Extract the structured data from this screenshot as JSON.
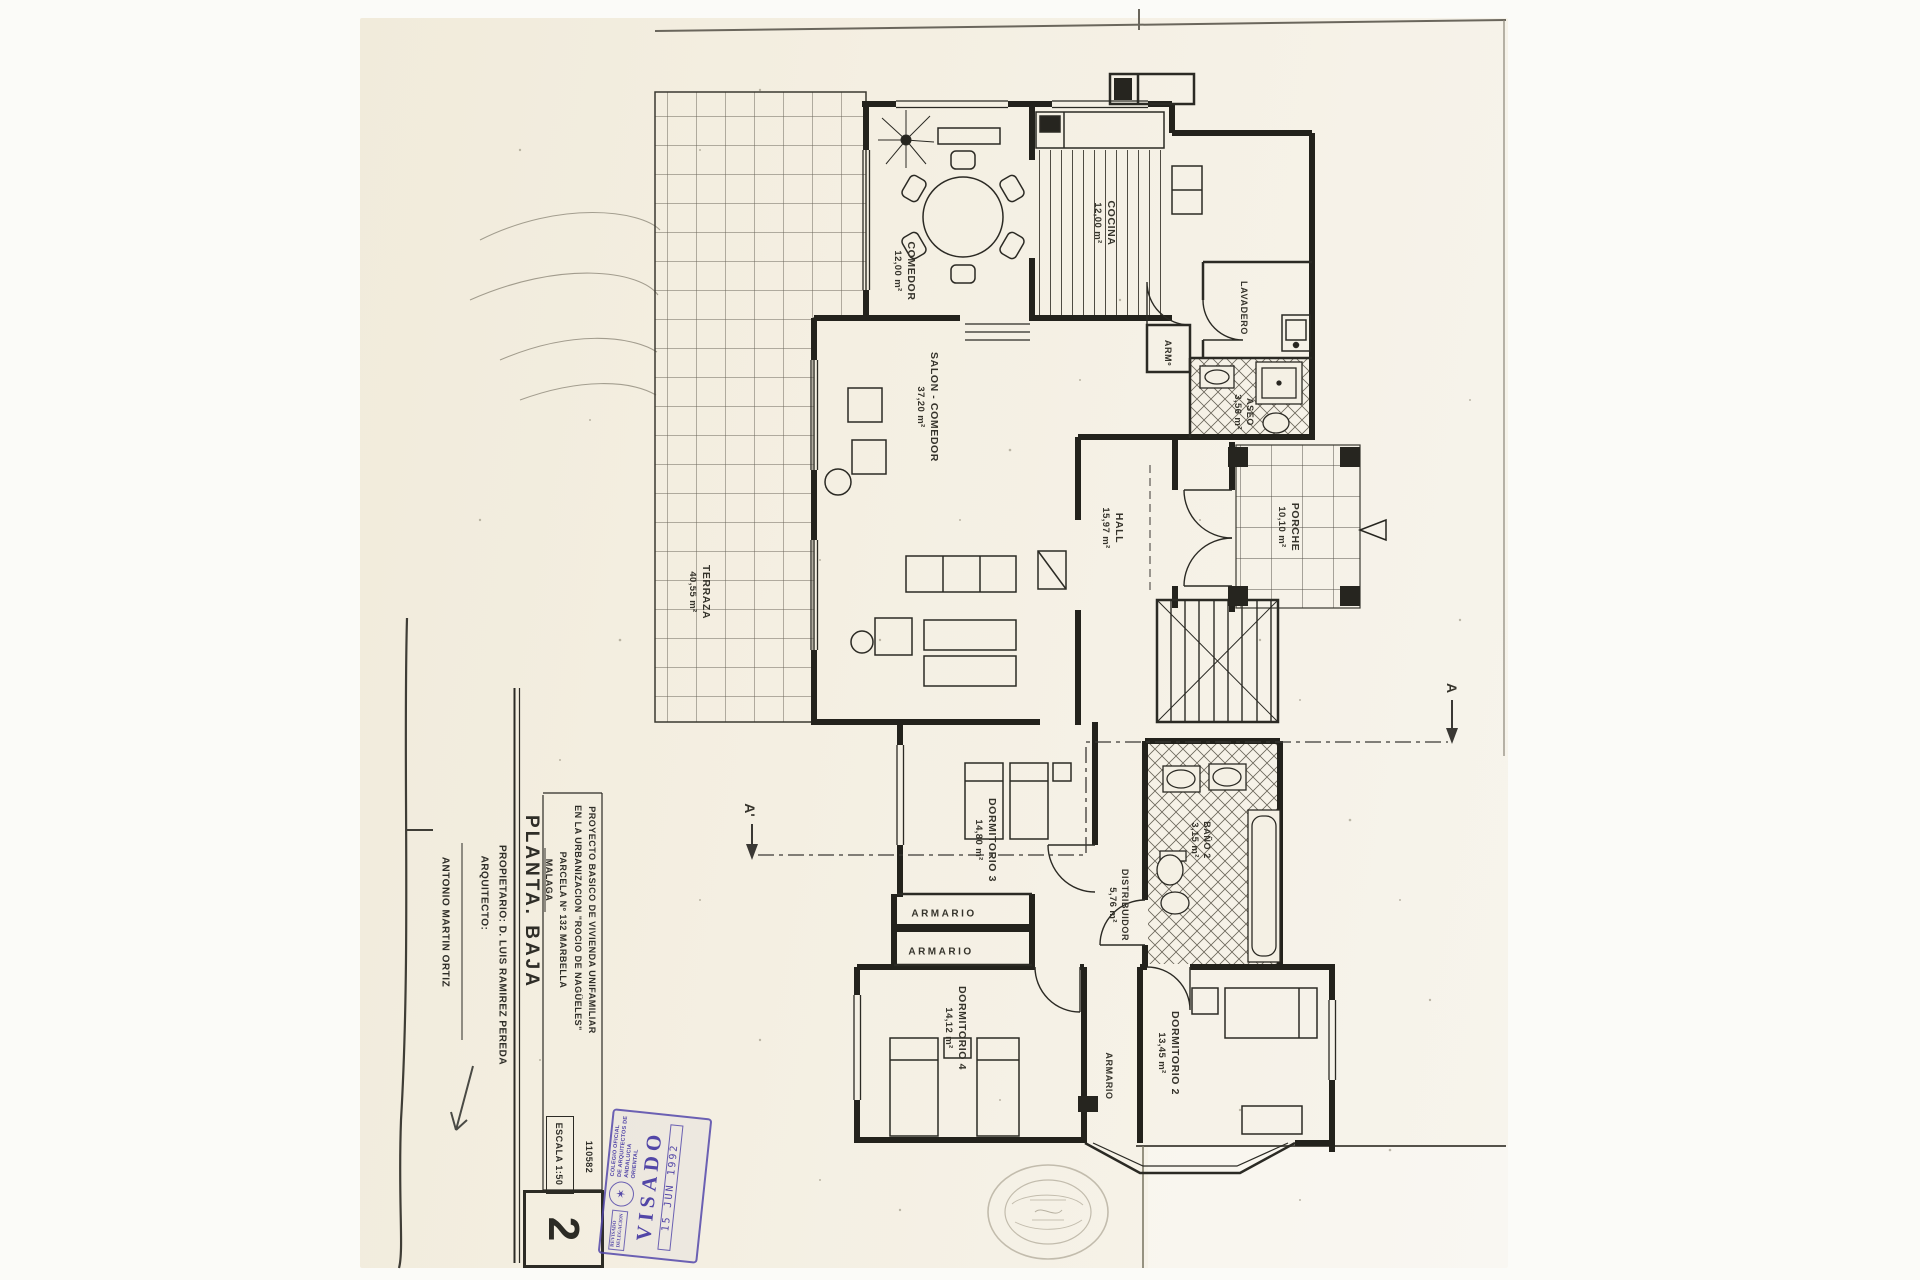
{
  "colors": {
    "paper": "#f4efe2",
    "ink": "#26251f",
    "stamp": "#5246a7",
    "seal": "#b2ab9a"
  },
  "rooms": [
    {
      "id": "comedor",
      "name": "COMEDOR",
      "area": "12,00 m²"
    },
    {
      "id": "cocina",
      "name": "COCINA",
      "area": "12,00 m²"
    },
    {
      "id": "lavadero",
      "name": "LAVADERO",
      "area": ""
    },
    {
      "id": "arm",
      "name": "ARMº",
      "area": ""
    },
    {
      "id": "aseo",
      "name": "ASEO",
      "area": "3,56 m²"
    },
    {
      "id": "salon",
      "name": "SALON - COMEDOR",
      "area": "37,20 m²"
    },
    {
      "id": "hall",
      "name": "HALL",
      "area": "15,97 m²"
    },
    {
      "id": "porche",
      "name": "PORCHE",
      "area": "10,10 m²"
    },
    {
      "id": "terraza",
      "name": "TERRAZA",
      "area": "40,55 m²"
    },
    {
      "id": "dormitorio3",
      "name": "DORMITORIO 3",
      "area": "14,80 m²"
    },
    {
      "id": "distribuidor",
      "name": "DISTRIBUIDOR",
      "area": "5,76 m²"
    },
    {
      "id": "bano2",
      "name": "BAÑO 2",
      "area": "3,15 m²"
    },
    {
      "id": "armario1",
      "name": "ARMARIO",
      "area": ""
    },
    {
      "id": "armario2",
      "name": "ARMARIO",
      "area": ""
    },
    {
      "id": "armario3",
      "name": "ARMARIO",
      "area": ""
    },
    {
      "id": "dormitorio4",
      "name": "DORMITORIO 4",
      "area": "14,12 m²"
    },
    {
      "id": "dormitorio2",
      "name": "DORMITORIO 2",
      "area": "13,45 m²"
    }
  ],
  "section_marks": {
    "a": "A",
    "a_prime": "A'"
  },
  "title_block": {
    "project_line1": "PROYECTO BASICO DE VIVIENDA UNIFAMILIAR",
    "project_line2": "EN LA URBANIZACION \"ROCIO DE NAGÜELES\"",
    "project_line3": "PARCELA Nº 132   MARBELLA",
    "project_line4": "MALAGA",
    "plan_title": "PLANTA. BAJA",
    "owner": "PROPIETARIO: D. LUIS RAMIREZ PEREDA",
    "architect_label": "ARQUITECTO:",
    "architect_name": "ANTONIO MARTIN ORTIZ",
    "scale": "ESCALA 1:50",
    "reference": "110582",
    "sheet_number": "2"
  },
  "visado_stamp": {
    "title": "VISADO",
    "date": "15 JUN 1992",
    "org_line1": "COLEGIO OFICIAL",
    "org_line2": "DE ARQUITECTOS DE",
    "org_line3": "ANDALUCIA ORIENTAL",
    "small_left1": "REVISADO",
    "small_left2": "DELEGACION",
    "emblem_glyph": "✶"
  }
}
